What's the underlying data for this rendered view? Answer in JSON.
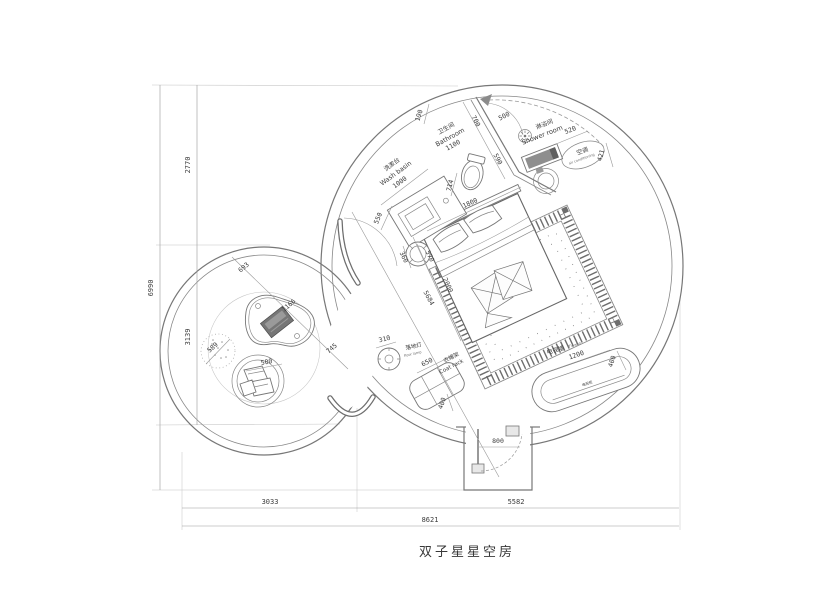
{
  "title": "双子星星空房",
  "labels": {
    "washbasin_zh": "洗漱台",
    "washbasin_en": "Wash basin",
    "bathroom_zh": "卫生间",
    "bathroom_en": "Bathroom",
    "shower_zh": "淋浴间",
    "shower_en": "Shower room",
    "ac_zh": "空调",
    "ac_en": "air conditioning",
    "floorlamp_zh": "落地灯",
    "floorlamp_en": "floor lamp",
    "coatrack_zh": "衣帽架",
    "coatrack_en": "Coat rack",
    "tvwall_zh": "电视墙",
    "tvwall_en": "TV wall",
    "tvcabinet_zh": "电视柜"
  },
  "dims": {
    "total_height": "6990",
    "height_upper": "2770",
    "height_lower": "3139",
    "total_width": "8621",
    "width_left": "3033",
    "width_right": "5582",
    "door_width": "800",
    "top_offset": "190",
    "wall_upper": "700",
    "wall_lower": "590",
    "shower_door": "500",
    "bathroom_width": "1100",
    "washbasin_width": "1000",
    "vanity_side": "550",
    "toilet_width": "714",
    "bed_width": "1800",
    "bed_length": "2000",
    "stool": "360",
    "stool_gap": "570",
    "room_diagonal": "5684",
    "shower_bench": "520",
    "ac_clearance": "421",
    "lamp_dia": "310",
    "coatrack_width": "650",
    "coatrack_depth": "400",
    "tv_width": "1200",
    "tv_depth": "400",
    "pod_seg_a": "693",
    "pod_seg_b": "1166",
    "pod_seg_c": "745",
    "pouf_dia": "589",
    "pillow_circle": "500"
  }
}
